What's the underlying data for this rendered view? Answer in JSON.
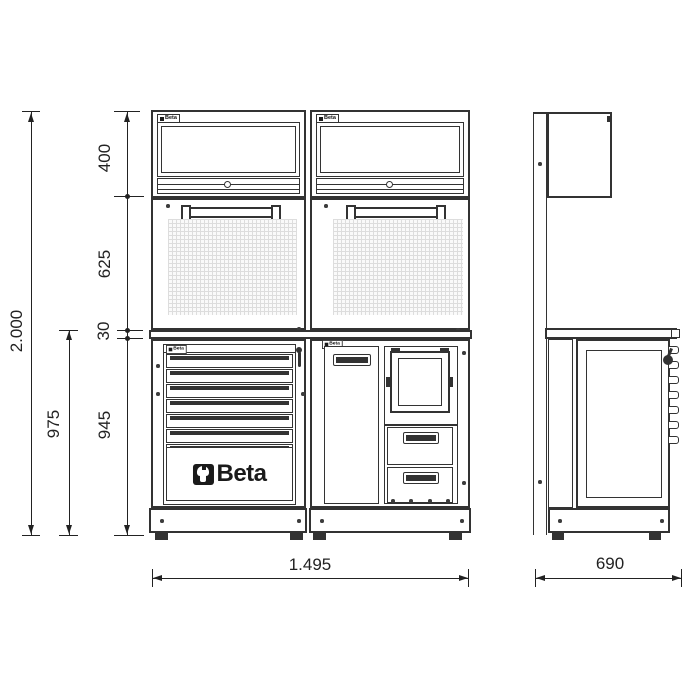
{
  "colors": {
    "line": "#333333",
    "dim": "#222222",
    "pegboard": "#dddddd",
    "logo": "#1a1a1a"
  },
  "brand": {
    "logo_text": "Beta",
    "mini_label": "Beta"
  },
  "dimensions": {
    "total_height": "2.000",
    "upper_cabinet_height": "400",
    "back_panel_height": "625",
    "worktop_thickness": "30",
    "base_unit_height": "945",
    "bench_height": "975",
    "overall_width": "1.495",
    "overall_depth": "690"
  },
  "icons": {
    "wrench": "beta-wrench-mark",
    "lock": "round-lock",
    "key": "key-in-lock"
  }
}
